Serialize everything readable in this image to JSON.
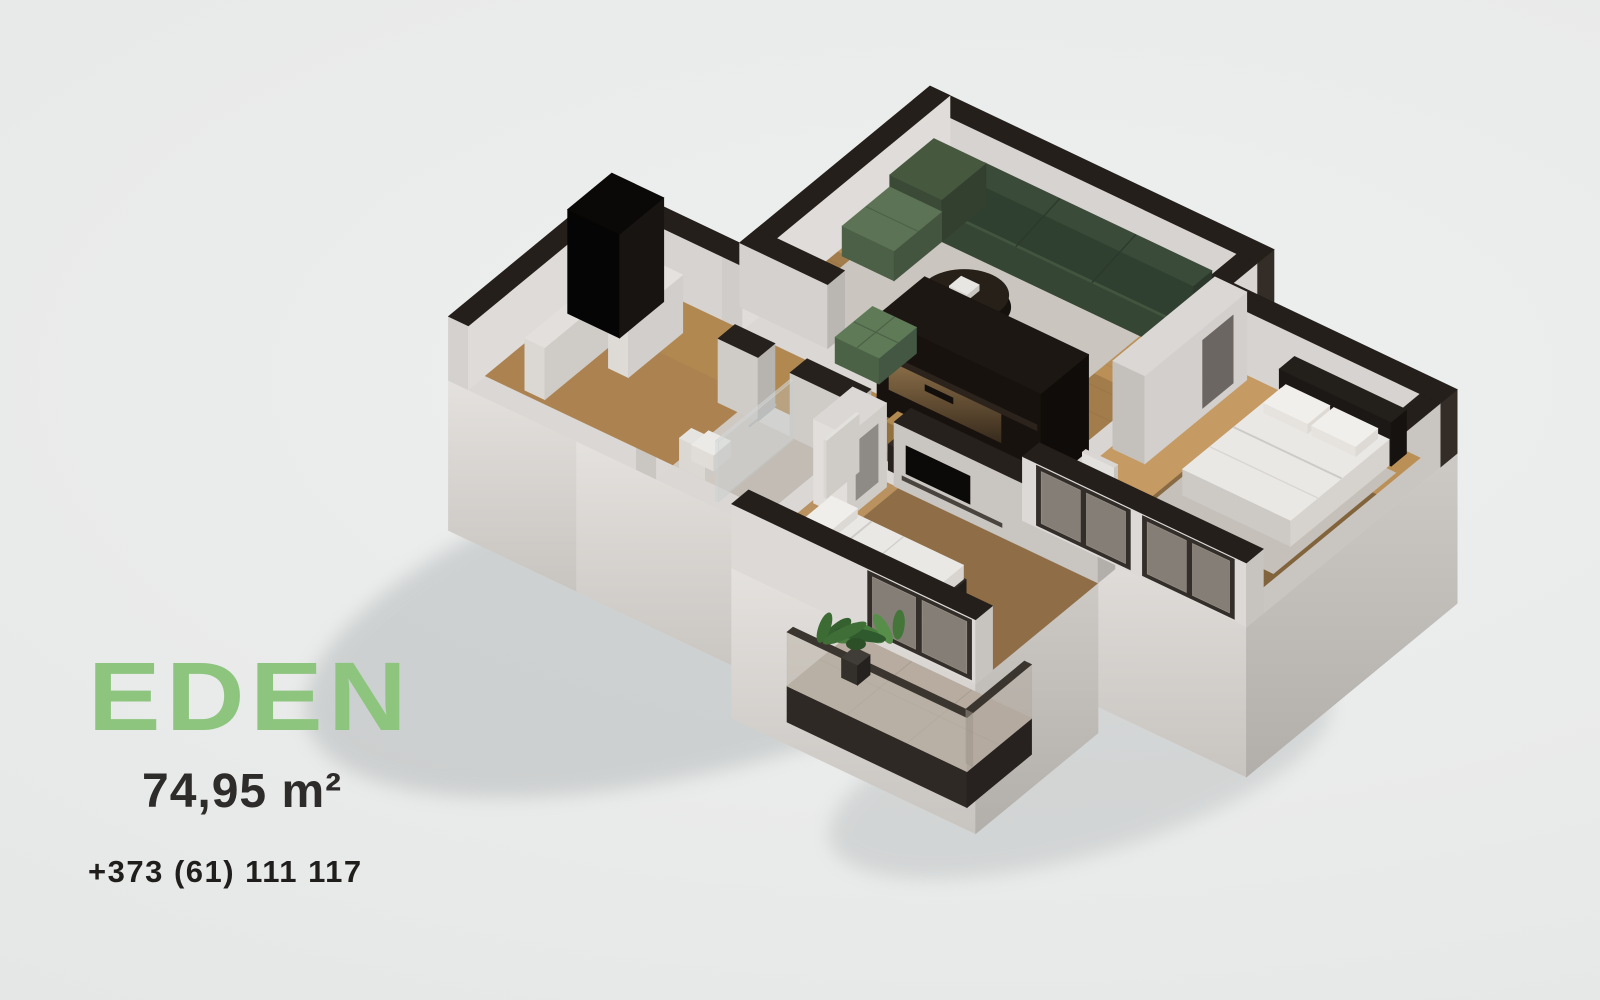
{
  "brand": {
    "name": "EDEN",
    "accent_color": "#8dc57f"
  },
  "listing": {
    "area_label": "74,95 m²",
    "phone_label": "+373 (61) 111 117"
  },
  "palette": {
    "background": "#e9eaea",
    "text_dark": "#2d2c2a",
    "wall_top_dark": "#241f1b",
    "wall_light": "#dedbd8",
    "wall_shade": "#c7c3bf",
    "wood_floor": "#bb9057",
    "wood_floor_dark": "#8f6d46",
    "rug_gray": "#cac5bf",
    "sofa_green_dark": "#42553f",
    "sofa_green_light": "#5d7355",
    "kitchen_dark": "#17120e",
    "kitchen_glow": "#8a6c47",
    "bedding_white": "#eae8e5",
    "balcony_floor": "#b7ac9f",
    "plant_green": "#477d3c",
    "glass_tint": "rgba(188,180,170,0.6)"
  },
  "scene": {
    "type": "isometric-floorplan-render",
    "rooms": [
      "living room",
      "kitchen",
      "master bedroom",
      "second bedroom",
      "bathroom",
      "entry hall",
      "balcony"
    ]
  }
}
